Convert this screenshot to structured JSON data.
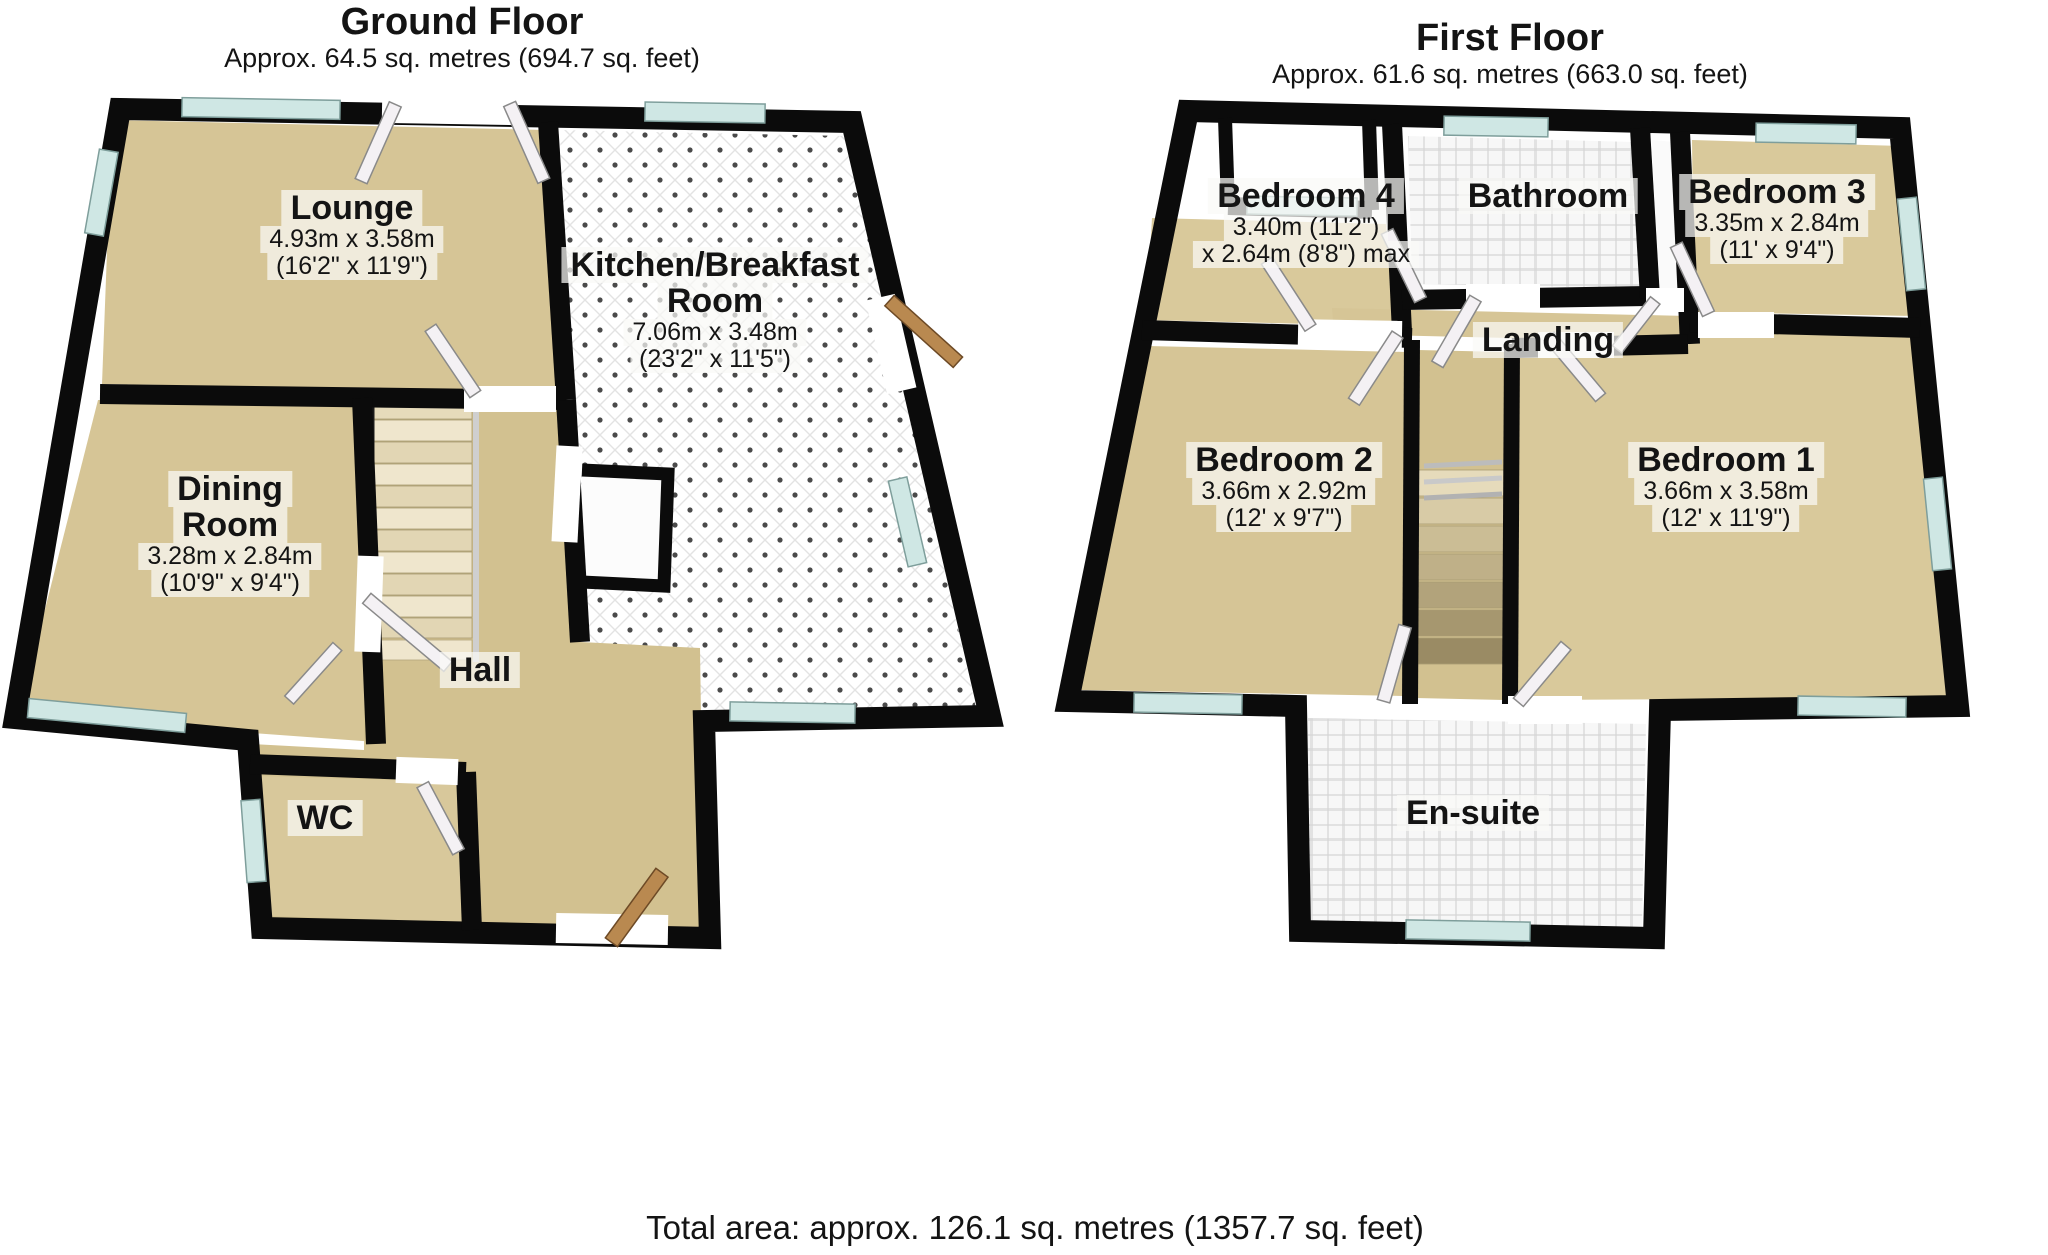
{
  "footer": {
    "total_area": "Total area: approx. 126.1 sq. metres (1357.7 sq. feet)"
  },
  "colors": {
    "wall": "#0b0b0b",
    "carpet": "#d6c596",
    "window_glass": "#cfe7e4",
    "tile_grout": "#d6d6d6",
    "door_leaf": "#f4f1f4",
    "wood_door": "#b98950"
  },
  "floors": [
    {
      "id": "ground",
      "title": "Ground Floor",
      "subtitle": "Approx. 64.5 sq. metres (694.7 sq. feet)",
      "rooms": [
        {
          "name_lines": [
            "Lounge"
          ],
          "dim_line1": "4.93m x 3.58m",
          "dim_line2": "(16'2\" x 11'9\")"
        },
        {
          "name_lines": [
            "Kitchen/Breakfast",
            "Room"
          ],
          "dim_line1": "7.06m x 3.48m",
          "dim_line2": "(23'2\" x 11'5\")"
        },
        {
          "name_lines": [
            "Dining",
            "Room"
          ],
          "dim_line1": "3.28m x 2.84m",
          "dim_line2": "(10'9\" x 9'4\")"
        },
        {
          "name_lines": [
            "Hall"
          ]
        },
        {
          "name_lines": [
            "WC"
          ]
        }
      ]
    },
    {
      "id": "first",
      "title": "First Floor",
      "subtitle": "Approx. 61.6 sq. metres (663.0 sq. feet)",
      "rooms": [
        {
          "name_lines": [
            "Bedroom 4"
          ],
          "dim_line1": "3.40m (11'2\")",
          "dim_line2": "x 2.64m (8'8\") max"
        },
        {
          "name_lines": [
            "Bathroom"
          ]
        },
        {
          "name_lines": [
            "Bedroom 3"
          ],
          "dim_line1": "3.35m x 2.84m",
          "dim_line2": "(11' x 9'4\")"
        },
        {
          "name_lines": [
            "Landing"
          ]
        },
        {
          "name_lines": [
            "Bedroom 2"
          ],
          "dim_line1": "3.66m x 2.92m",
          "dim_line2": "(12' x 9'7\")"
        },
        {
          "name_lines": [
            "Bedroom 1"
          ],
          "dim_line1": "3.66m x 3.58m",
          "dim_line2": "(12' x 11'9\")"
        },
        {
          "name_lines": [
            "En-suite"
          ]
        }
      ]
    }
  ]
}
